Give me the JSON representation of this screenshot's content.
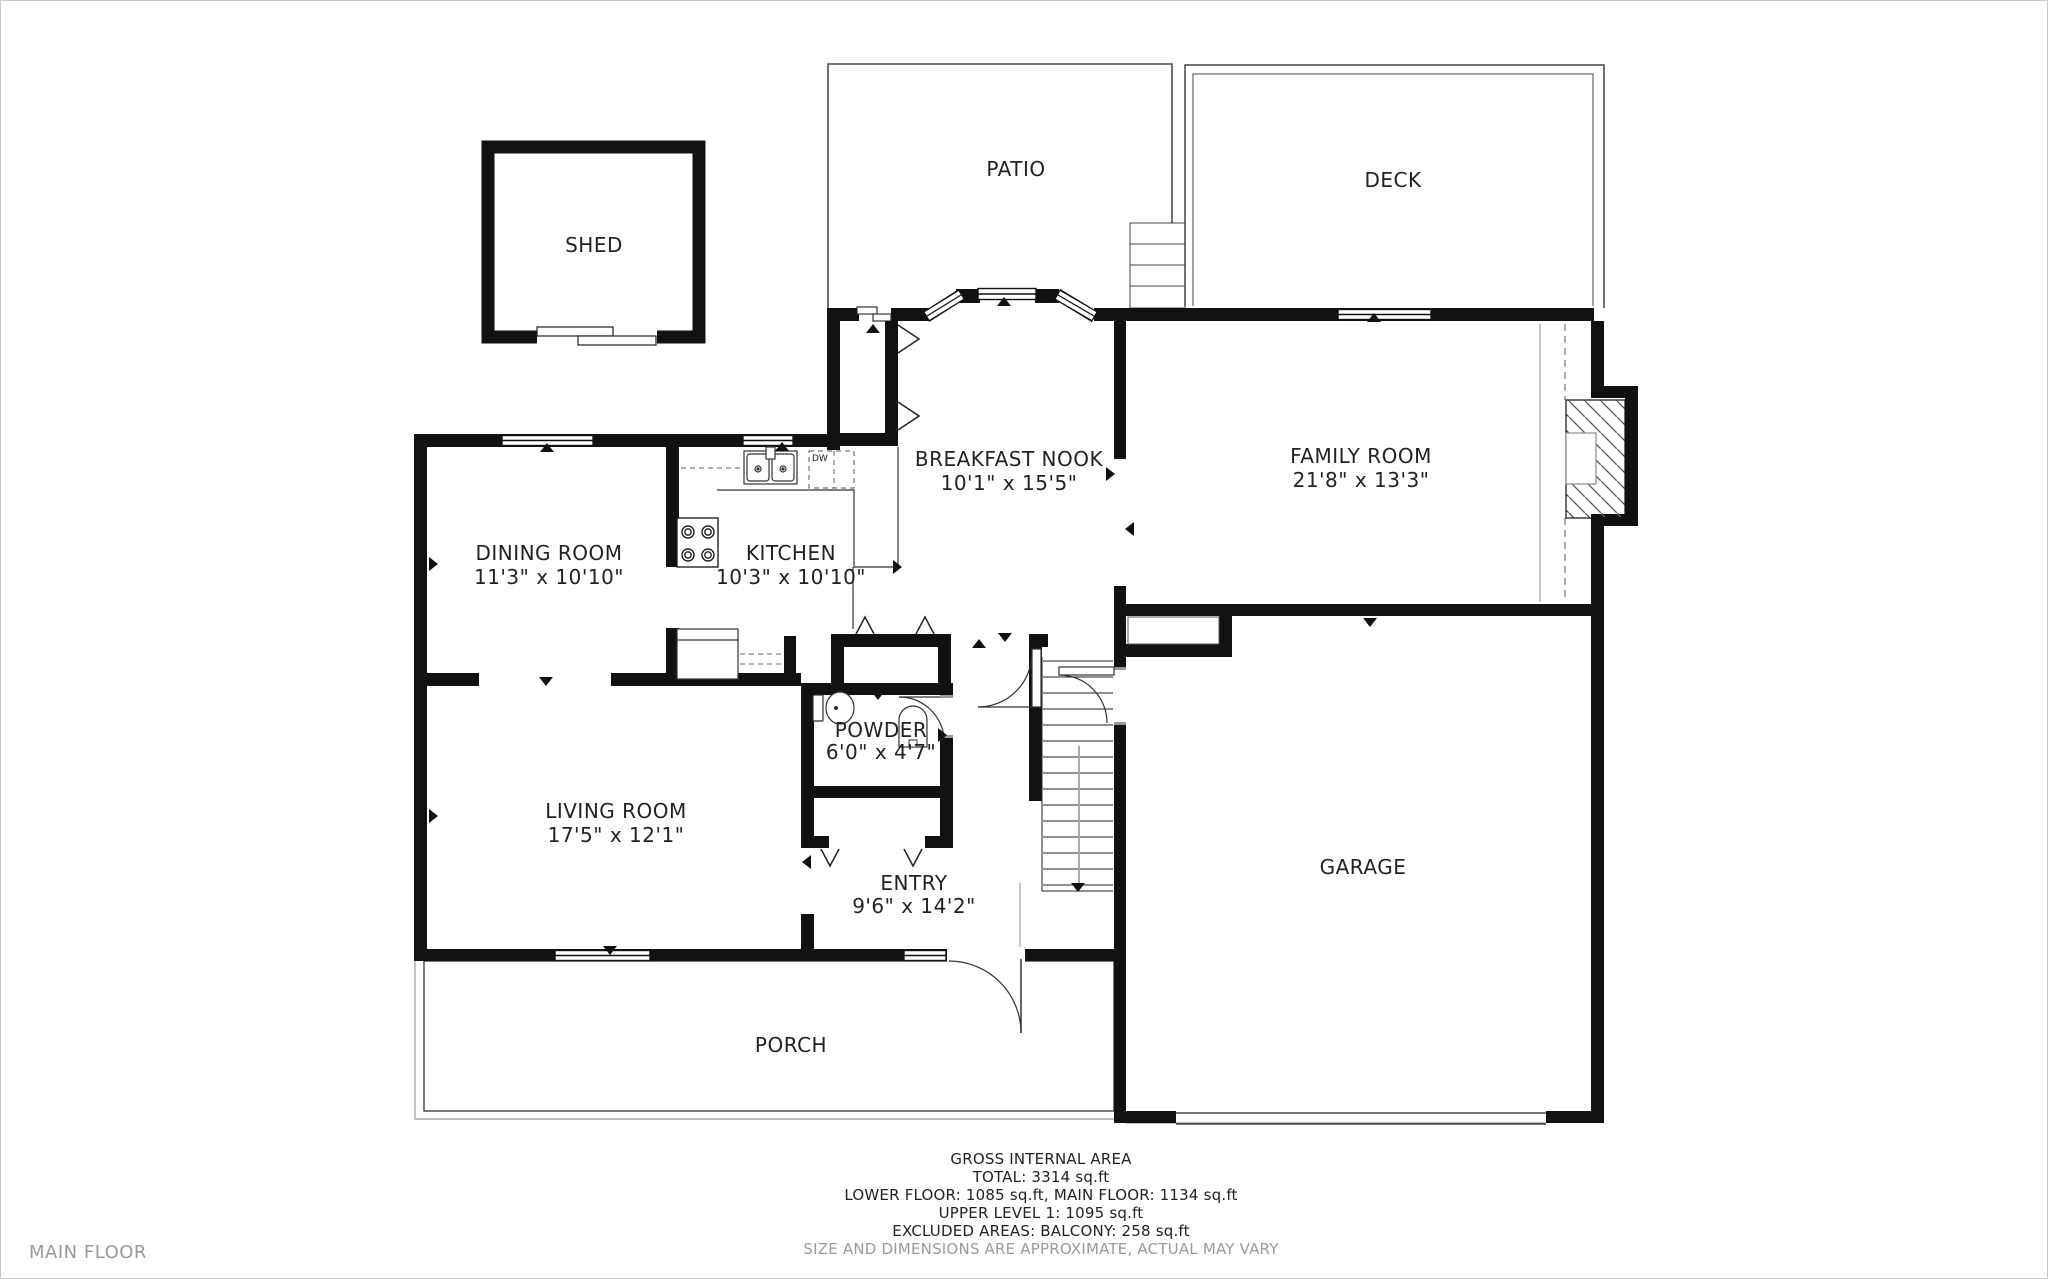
{
  "page": {
    "floor_name": "MAIN FLOOR"
  },
  "rooms": {
    "shed": {
      "label": "SHED"
    },
    "patio": {
      "label": "PATIO"
    },
    "deck": {
      "label": "DECK"
    },
    "breakfast_nook": {
      "label": "BREAKFAST NOOK",
      "dims": "10'1\" x 15'5\""
    },
    "family_room": {
      "label": "FAMILY ROOM",
      "dims": "21'8\" x 13'3\""
    },
    "dining_room": {
      "label": "DINING ROOM",
      "dims": "11'3\" x 10'10\""
    },
    "kitchen": {
      "label": "KITCHEN",
      "dims": "10'3\" x 10'10\""
    },
    "powder": {
      "label": "POWDER",
      "dims": "6'0\" x 4'7\""
    },
    "living_room": {
      "label": "LIVING ROOM",
      "dims": "17'5\" x 12'1\""
    },
    "entry": {
      "label": "ENTRY",
      "dims": "9'6\" x 14'2\""
    },
    "garage": {
      "label": "GARAGE"
    },
    "porch": {
      "label": "PORCH"
    }
  },
  "fixtures": {
    "dishwasher_label": "DW"
  },
  "area_summary": {
    "line1": "GROSS INTERNAL AREA",
    "line2": "TOTAL: 3314 sq.ft",
    "line3": "LOWER FLOOR: 1085 sq.ft, MAIN FLOOR: 1134 sq.ft",
    "line4": "UPPER LEVEL 1: 1095 sq.ft",
    "line5": "EXCLUDED AREAS: BALCONY: 258 sq.ft",
    "disclaimer": "SIZE AND DIMENSIONS ARE APPROXIMATE, ACTUAL MAY VARY"
  },
  "colors": {
    "wall": "#111111",
    "text": "#222222",
    "muted": "#9a9a9a",
    "background": "#ffffff"
  }
}
